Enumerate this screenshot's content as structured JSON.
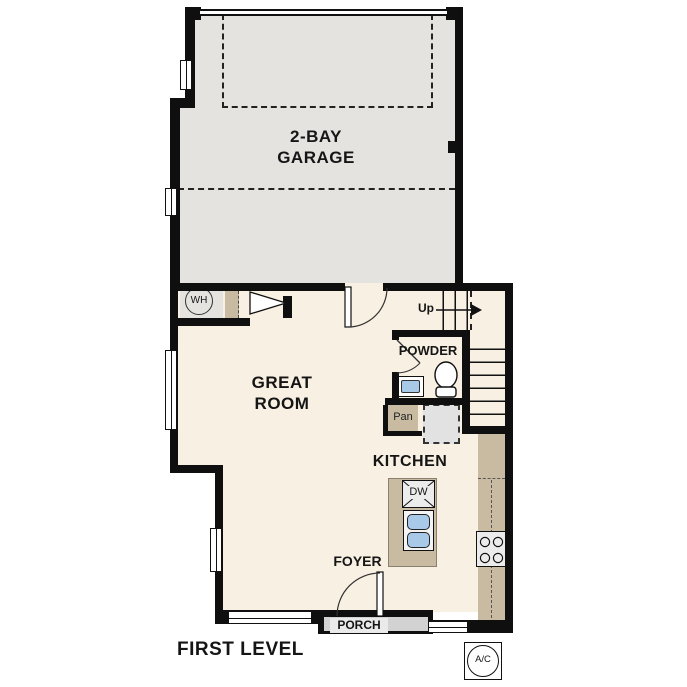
{
  "title": "FIRST LEVEL",
  "rooms": {
    "garage": {
      "line1": "2-BAY",
      "line2": "GARAGE"
    },
    "great_room": {
      "line1": "GREAT",
      "line2": "ROOM"
    },
    "powder": {
      "label": "POWDER"
    },
    "pantry": {
      "label": "Pan"
    },
    "kitchen": {
      "label": "KITCHEN"
    },
    "foyer": {
      "label": "FOYER"
    },
    "porch": {
      "label": "PORCH"
    }
  },
  "annotations": {
    "stairs_direction": "Up",
    "water_heater": "WH",
    "dishwasher": "DW",
    "ac_unit": "A/C"
  },
  "colors": {
    "wall": "#0f0f0f",
    "garage_floor": "#e4e3e0",
    "interior_floor": "#f8f0e2",
    "cabinet_tan": "#c8bba2",
    "sink_blue": "#a9c9e9",
    "appliance_gray": "#ececec",
    "fridge_gray": "#e2e2e2",
    "porch_gray": "#d2d2d2"
  }
}
